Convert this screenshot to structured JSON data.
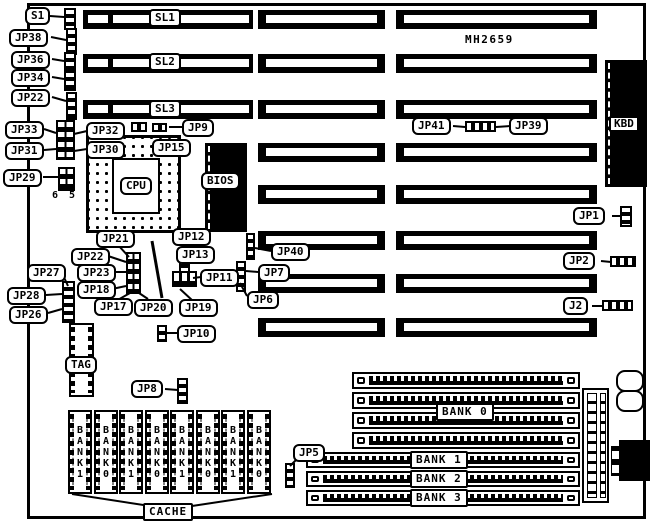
{
  "board": {
    "part_number": "MH2659"
  },
  "slots": [
    "SL1",
    "SL2",
    "SL3"
  ],
  "memory_banks": [
    "BANK 0",
    "BANK 1",
    "BANK 2",
    "BANK 3"
  ],
  "cache_chips": [
    "BANK1",
    "BANK0",
    "BANK1",
    "BANK0",
    "BANK1",
    "BANK0",
    "BANK1",
    "BANK0"
  ],
  "labels": {
    "s1": "S1",
    "jp38": "JP38",
    "jp36": "JP36",
    "jp34": "JP34",
    "jp22_top": "JP22",
    "jp33": "JP33",
    "jp31": "JP31",
    "jp29": "JP29",
    "jp32": "JP32",
    "jp30": "JP30",
    "jp9": "JP9",
    "jp15": "JP15",
    "jp41": "JP41",
    "jp39": "JP39",
    "kbd": "KBD",
    "bios": "BIOS",
    "cpu": "CPU",
    "jp1": "JP1",
    "jp2": "JP2",
    "j2": "J2",
    "jp21": "JP21",
    "jp12": "JP12",
    "jp22_mid": "JP22",
    "jp13": "JP13",
    "jp23": "JP23",
    "jp27": "JP27",
    "jp18": "JP18",
    "jp11": "JP11",
    "jp28": "JP28",
    "jp26": "JP26",
    "jp17": "JP17",
    "jp20": "JP20",
    "jp19": "JP19",
    "jp40": "JP40",
    "jp7": "JP7",
    "jp6": "JP6",
    "jp10": "JP10",
    "jp8": "JP8",
    "jp5": "JP5",
    "tag": "TAG",
    "cache": "CACHE",
    "pin6": "6",
    "pin5": "5"
  },
  "colors": {
    "ink": "#000000",
    "paper": "#ffffff"
  }
}
